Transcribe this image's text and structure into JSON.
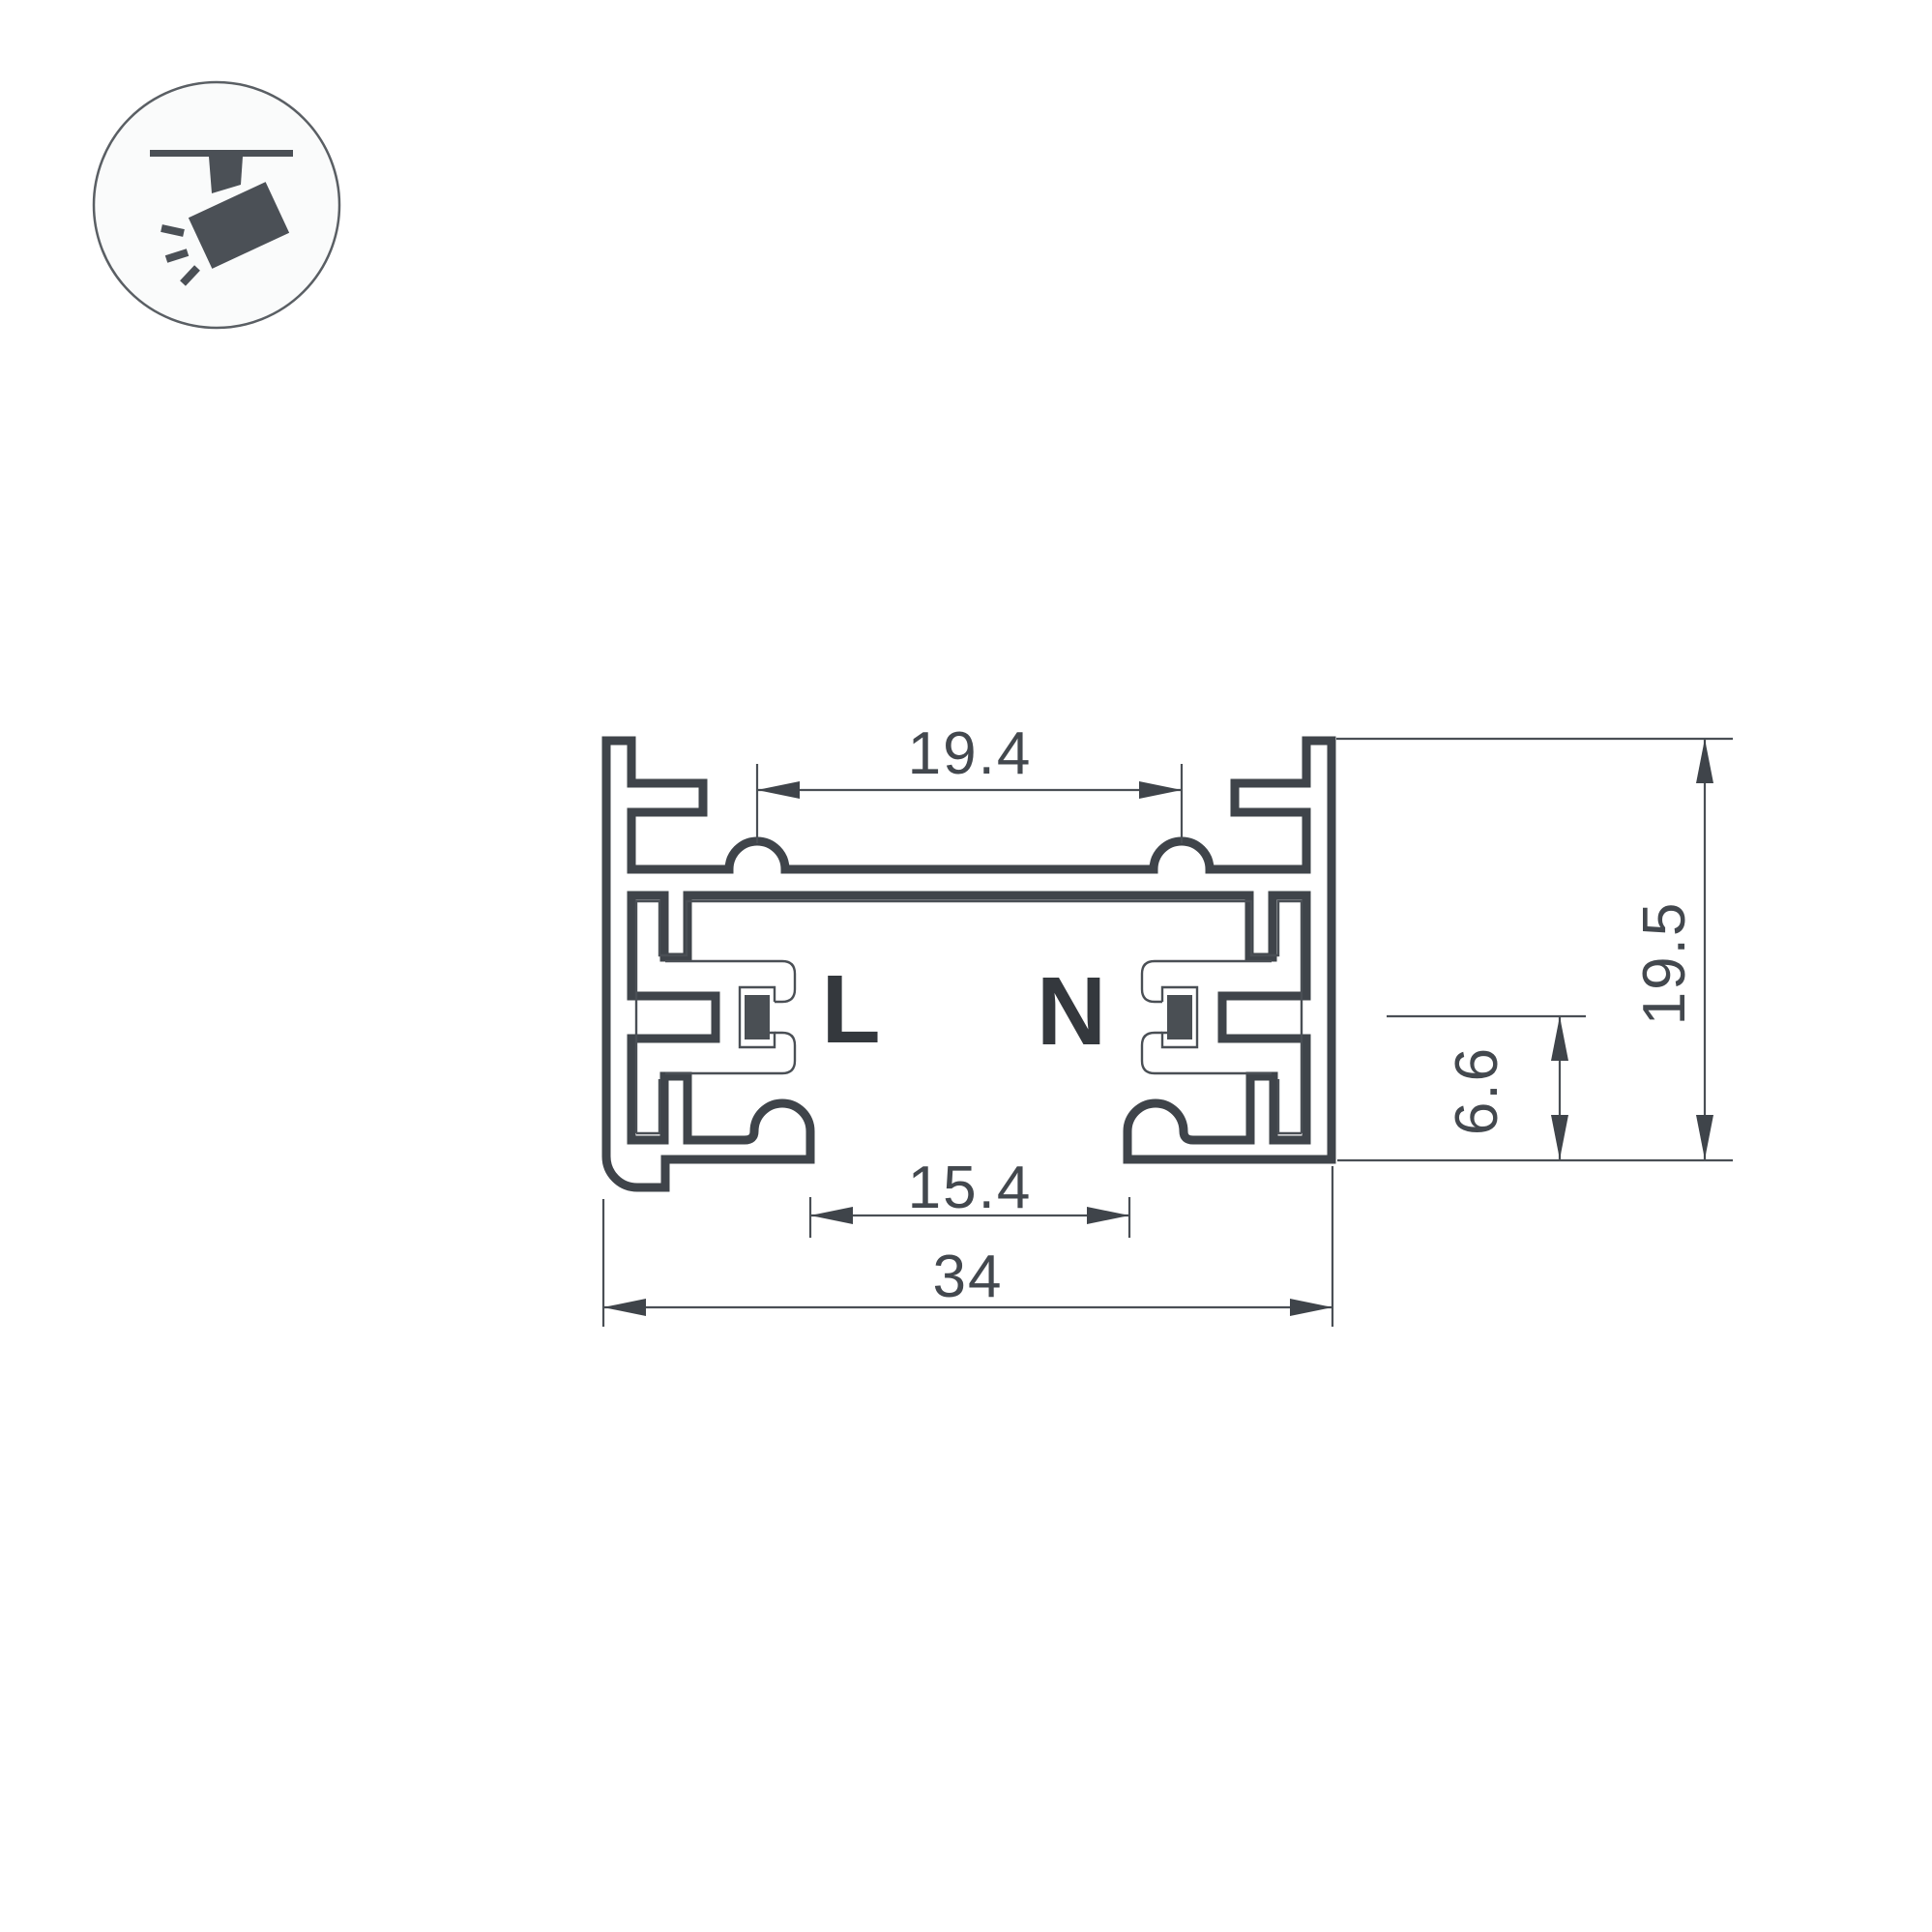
{
  "drawing": {
    "title": "track-busway-profile-cross-section",
    "labels": {
      "live": "L",
      "neutral": "N"
    },
    "dimensions": {
      "top_inner_width": {
        "value": "19.4"
      },
      "overall_height": {
        "value": "19.5"
      },
      "conductor_height": {
        "value": "6.6"
      },
      "slot_opening": {
        "value": "15.4"
      },
      "overall_width": {
        "value": "34"
      }
    },
    "colors": {
      "outline": "#3f444a",
      "thin_line": "#4a4f55",
      "dimension_text": "#43484e",
      "conductor_fill": "#4a4f54",
      "background": "#ffffff",
      "icon_stroke": "#5a5f64"
    }
  },
  "icon": {
    "name": "track-spotlight-icon"
  }
}
